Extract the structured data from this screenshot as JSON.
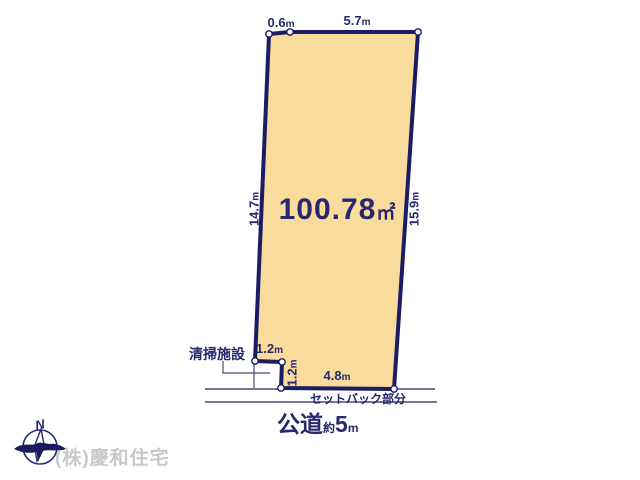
{
  "diagram": {
    "title_hint": "land-plot-diagram",
    "area": {
      "value": "100.78",
      "unit": "㎡"
    },
    "dimensions": {
      "top_left": {
        "value": "0.6",
        "unit": "m"
      },
      "top": {
        "value": "5.7",
        "unit": "m"
      },
      "left": {
        "value": "14.7",
        "unit": "m"
      },
      "right": {
        "value": "15.9",
        "unit": "m"
      },
      "notch_width": {
        "value": "1.2",
        "unit": "m"
      },
      "notch_height": {
        "value": "1.2",
        "unit": "m"
      },
      "bottom": {
        "value": "4.8",
        "unit": "m"
      }
    },
    "facility_label": "清掃施設",
    "setback_label": "セットバック部分",
    "road": {
      "name": "公道",
      "approx": "約",
      "value": "5",
      "unit": "m"
    },
    "compass": {
      "north_label": "N"
    }
  },
  "footer": {
    "company": "(株)慶和住宅"
  },
  "colors": {
    "plot_fill": "#F9DC9B",
    "plot_border": "#1B1B66",
    "text": "#28286E",
    "thin_line": "#4A4A78",
    "company_text": "#C9C9C9",
    "vertex_dot": "#FFFFFF"
  }
}
